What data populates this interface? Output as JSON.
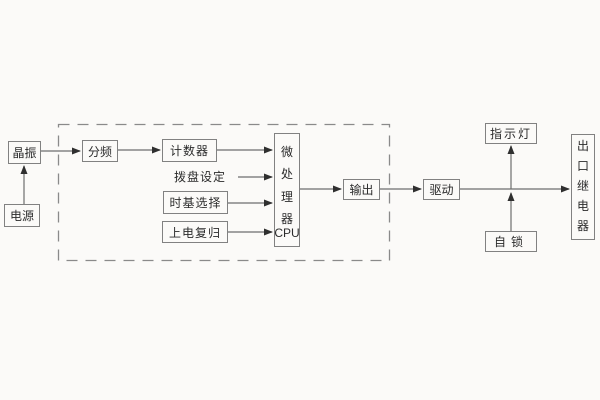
{
  "colors": {
    "background": "#fbfaf8",
    "box_border": "#818181",
    "line": "#6e6e6e",
    "arrowhead": "#2f2f2f",
    "text": "#2b2b2b",
    "dashed_border": "#8a8a8a"
  },
  "diagram": {
    "title": "relay-timer-block-diagram",
    "nodes": {
      "crystal": {
        "label": "晶振"
      },
      "power": {
        "label": "电源"
      },
      "divider": {
        "label": "分频"
      },
      "counter": {
        "label": "计数器"
      },
      "dial_setting": {
        "label": "拨盘设定"
      },
      "timebase_select": {
        "label": "时基选择"
      },
      "power_on_reset": {
        "label": "上电复归"
      },
      "cpu": {
        "label_vertical": "微处理器",
        "label_sub": "CPU"
      },
      "output": {
        "label": "输出"
      },
      "drive": {
        "label": "驱动"
      },
      "indicator_light": {
        "label": "指示灯"
      },
      "self_lock": {
        "label": "自锁"
      },
      "outlet_relay": {
        "label": "出口继电器"
      }
    }
  }
}
